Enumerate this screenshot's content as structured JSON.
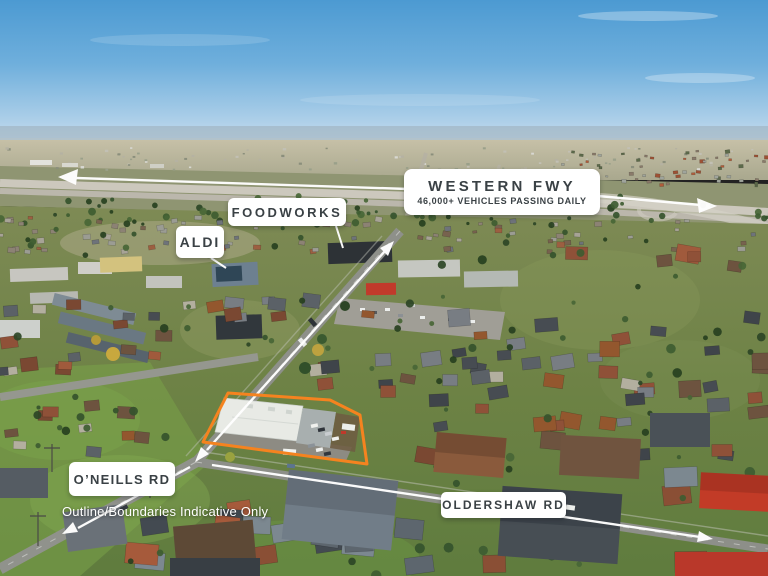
{
  "labels": {
    "western_fwy": {
      "title": "WESTERN FWY",
      "subtitle": "46,000+ VEHICLES PASSING DAILY"
    },
    "foodworks": {
      "text": "FOODWORKS"
    },
    "aldi": {
      "text": "ALDI"
    },
    "oneills_rd": {
      "text": "O’NEILLS RD"
    },
    "oldershaw_rd": {
      "text": "OLDERSHAW RD"
    }
  },
  "disclaimer": {
    "text": "Outline/Boundaries Indicative Only"
  },
  "colors": {
    "boundary_outline": "#F5831F",
    "annotation": "#FFFFFF",
    "label_bg": "#FFFFFF",
    "label_text": "#3A4145"
  },
  "annotations": {
    "arrows": [
      "freeway-west-arrow",
      "freeway-east-arrow",
      "connector-road-arrow",
      "oldershaw-rd-arrow",
      "oneills-rd-arrow"
    ],
    "leader_lines": [
      "foodworks-leader-line",
      "aldi-leader-line"
    ],
    "boundary": "property-boundary-outline"
  }
}
